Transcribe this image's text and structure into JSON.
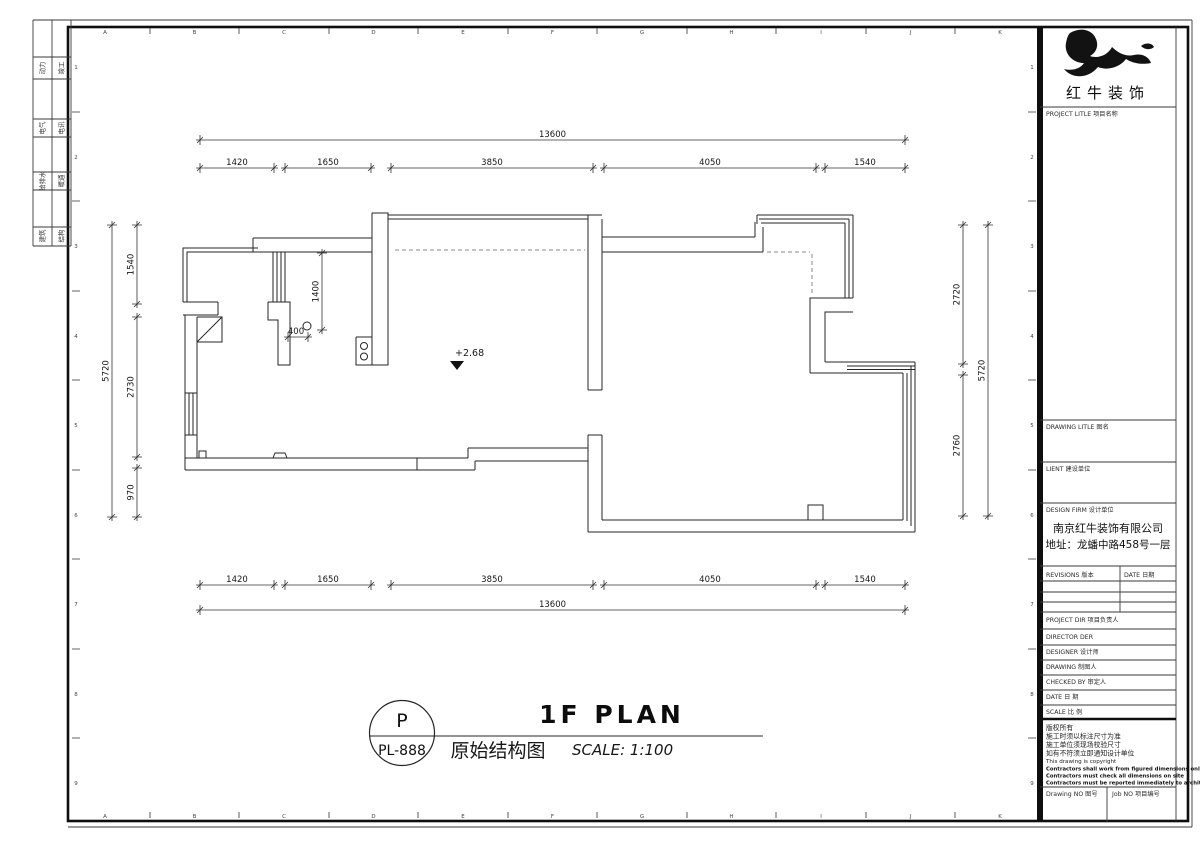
{
  "sheet": {
    "grid_letters": [
      "A",
      "B",
      "C",
      "D",
      "E",
      "F",
      "G",
      "H",
      "I",
      "J",
      "K"
    ],
    "grid_numbers": [
      "1",
      "2",
      "3",
      "4",
      "5",
      "6",
      "7",
      "8",
      "9"
    ]
  },
  "strip": {
    "rows": [
      {
        "left": "动力",
        "right": "竣工"
      },
      {
        "left": "电气",
        "right": "电讯"
      },
      {
        "left": "给排水",
        "right": "暖通"
      },
      {
        "left": "建筑",
        "right": "结构"
      }
    ]
  },
  "plan": {
    "dims_top": {
      "overall": "13600",
      "segments": [
        "1420",
        "1650",
        "3850",
        "4050",
        "1540"
      ]
    },
    "dims_bottom": {
      "overall": "13600",
      "segments": [
        "1420",
        "1650",
        "3850",
        "4050",
        "1540"
      ]
    },
    "dims_left": {
      "overall": "5720",
      "segments": [
        "1540",
        "2730",
        "970"
      ]
    },
    "dims_right": {
      "overall": "5720",
      "segments": [
        "2720",
        "2760"
      ]
    },
    "annotations": {
      "height_dim": "1400",
      "offset_dim": "400",
      "level": "+2.68"
    }
  },
  "titlebar": {
    "code_letter": "P",
    "code": "PL-888",
    "title_en": "1F PLAN",
    "title_cn": "原始结构图",
    "scale": "SCALE: 1:100"
  },
  "titleblock": {
    "brand": "红牛装饰",
    "project_label": "PROJECT LITLE  项目名称",
    "drawing_label": "DRAWING LITLE  图名",
    "client_label": "LIENT  建设单位",
    "design_firm_label": "DESIGN FIRM  设计单位",
    "firm_name": "南京红牛装饰有限公司",
    "firm_address": "地址：龙蟠中路458号一层",
    "revisions_label": "REVISIONS  版本",
    "date_col_label": "DATE  日期",
    "project_dir_label": "PROJECT DIR  项目负责人",
    "director_label": "DIRECTOR DER",
    "designer_label": "DESIGNER  设计师",
    "drawing_by_label": "DRAWING  制图人",
    "checked_label": "CHECKED BY  审定人",
    "date_label": "DATE  日 期",
    "scale_label": "SCALE  比 例",
    "copyright_lines": [
      "版权所有",
      "施工时须以标注尺寸为准",
      "施工单位须现场校验尺寸",
      "如有不符须立即通知设计单位",
      "This drawing is copyright",
      "Contractors shall work from figured dimensions only",
      "Contractors must check all dimensions on site",
      "Contractors must be reported immediately to architects"
    ],
    "drawing_no_label": "Drawing NO 图号",
    "job_no_label": "Job NO 项目编号"
  },
  "colors": {
    "ink": "#1c1c1c",
    "wall_line": "#262626",
    "dash": "#8a8a8a"
  }
}
